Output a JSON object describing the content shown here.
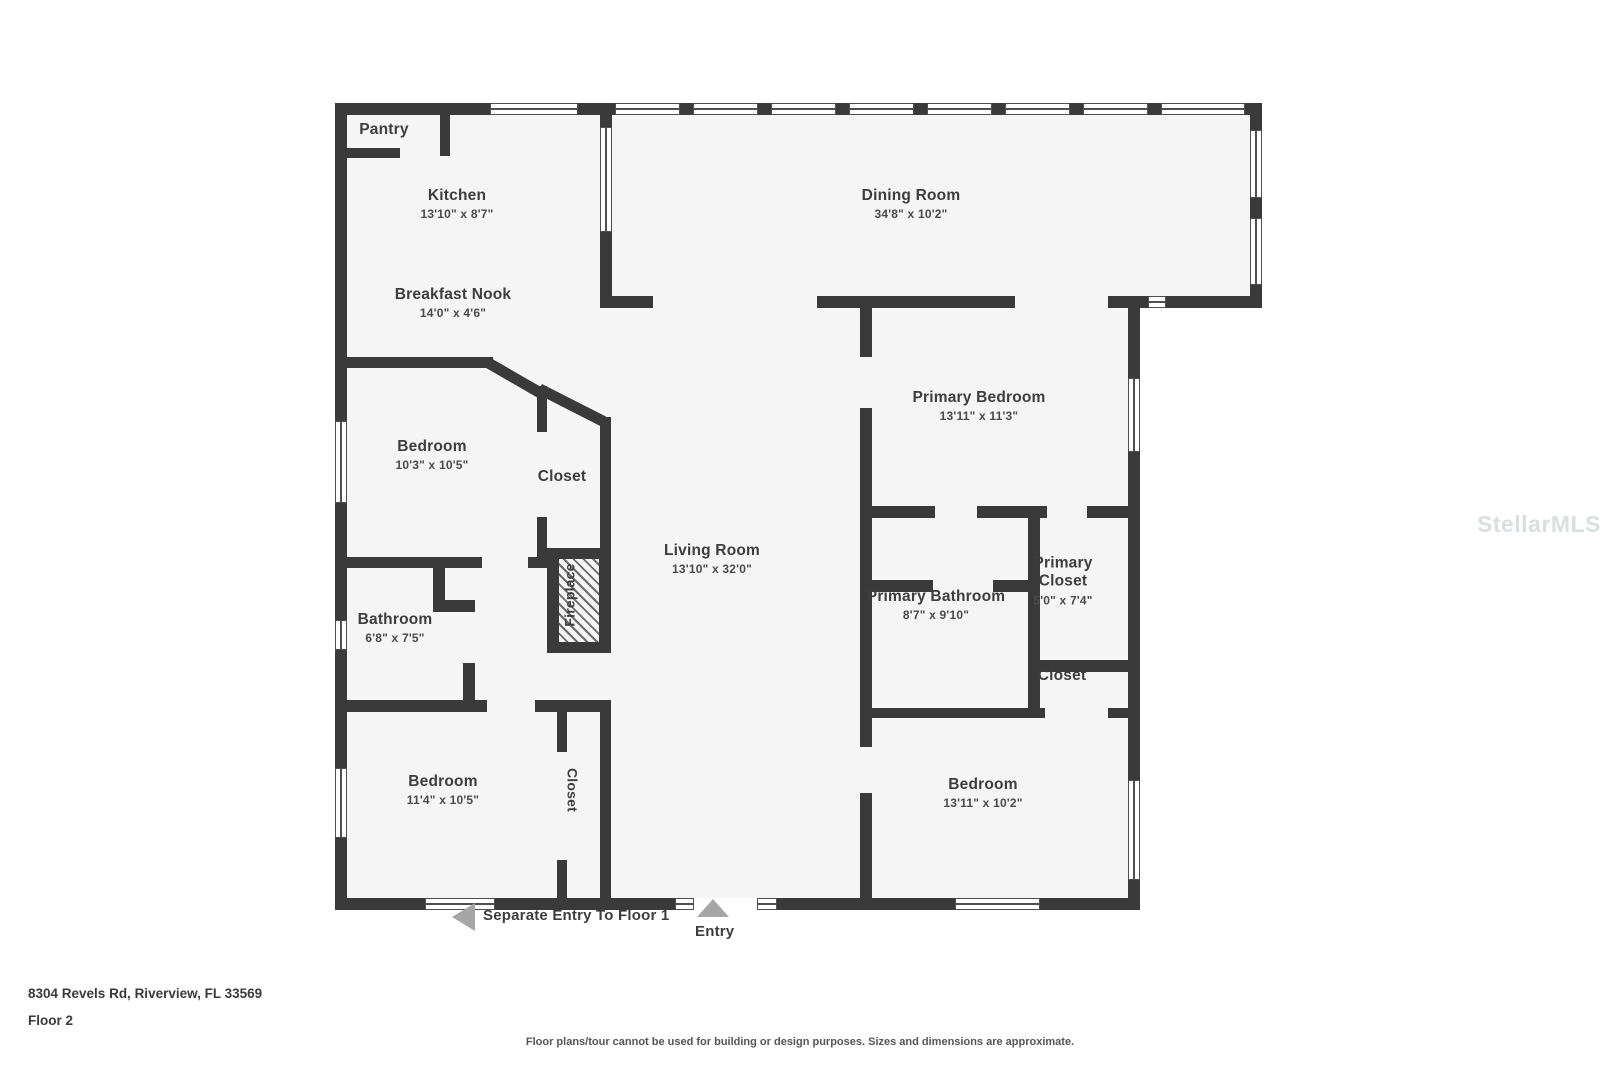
{
  "rooms": {
    "pantry": {
      "name": "Pantry"
    },
    "kitchen": {
      "name": "Kitchen",
      "dims": "13'10\" x 8'7\""
    },
    "breakfast_nook": {
      "name": "Breakfast Nook",
      "dims": "14'0\" x 4'6\""
    },
    "dining_room": {
      "name": "Dining Room",
      "dims": "34'8\" x 10'2\""
    },
    "bedroom_left": {
      "name": "Bedroom",
      "dims": "10'3\" x 10'5\""
    },
    "closet_mid": {
      "name": "Closet"
    },
    "living_room": {
      "name": "Living Room",
      "dims": "13'10\" x 32'0\""
    },
    "primary_bedroom": {
      "name": "Primary Bedroom",
      "dims": "13'11\" x 11'3\""
    },
    "bathroom": {
      "name": "Bathroom",
      "dims": "6'8\" x 7'5\""
    },
    "fireplace": {
      "name": "Fireplace"
    },
    "primary_bathroom": {
      "name": "Primary Bathroom",
      "dims": "8'7\" x 9'10\""
    },
    "primary_closet": {
      "name": "Primary Closet",
      "dims": "5'0\" x 7'4\""
    },
    "closet_small": {
      "name": "Closet"
    },
    "bedroom_bottom_left": {
      "name": "Bedroom",
      "dims": "11'4\" x 10'5\""
    },
    "closet_bottom": {
      "name": "Closet"
    },
    "bedroom_bottom_right": {
      "name": "Bedroom",
      "dims": "13'11\" x 10'2\""
    }
  },
  "annotations": {
    "separate_entry": "Separate Entry To Floor 1",
    "entry": "Entry"
  },
  "footer": {
    "address": "8304 Revels Rd, Riverview, FL 33569",
    "floor": "Floor 2",
    "disclaimer": "Floor plans/tour cannot be used for building or design purposes. Sizes and dimensions are approximate."
  },
  "watermark": "StellarMLS",
  "colors": {
    "wall": "#3a3a3a",
    "floor": "#f5f5f5",
    "text": "#3d3d3d",
    "arrow": "#a6a6a6"
  }
}
